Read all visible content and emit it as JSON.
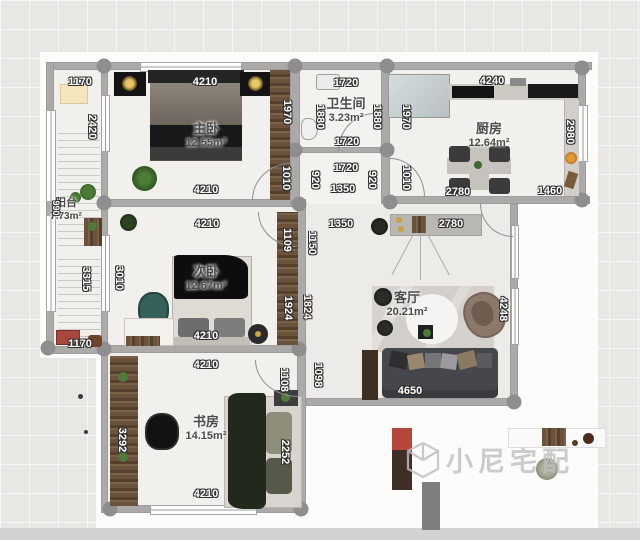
{
  "watermark": {
    "text": "小尼宅配"
  },
  "rooms": [
    {
      "name": "主卧",
      "area": "12.55m²",
      "x": 206,
      "y": 136,
      "small": false
    },
    {
      "name": "卫生间",
      "area": "3.23m²",
      "x": 346,
      "y": 111,
      "small": false
    },
    {
      "name": "厨房",
      "area": "12.64m²",
      "x": 489,
      "y": 136,
      "small": false
    },
    {
      "name": "阳台",
      "area": "7.73m²",
      "x": 66,
      "y": 210,
      "small": true
    },
    {
      "name": "次卧",
      "area": "12.67m²",
      "x": 206,
      "y": 279,
      "small": false
    },
    {
      "name": "客厅",
      "area": "20.21m²",
      "x": 407,
      "y": 305,
      "small": false
    },
    {
      "name": "书房",
      "area": "14.15m²",
      "x": 206,
      "y": 429,
      "small": false
    }
  ],
  "dims": [
    {
      "t": "1170",
      "x": 80,
      "y": 82,
      "o": "h"
    },
    {
      "t": "4210",
      "x": 205,
      "y": 82,
      "o": "h"
    },
    {
      "t": "1720",
      "x": 346,
      "y": 83,
      "o": "h"
    },
    {
      "t": "4240",
      "x": 492,
      "y": 81,
      "o": "h"
    },
    {
      "t": "1720",
      "x": 347,
      "y": 142,
      "o": "h"
    },
    {
      "t": "1720",
      "x": 346,
      "y": 168,
      "o": "h"
    },
    {
      "t": "1350",
      "x": 343,
      "y": 189,
      "o": "h"
    },
    {
      "t": "2780",
      "x": 458,
      "y": 192,
      "o": "h"
    },
    {
      "t": "1460",
      "x": 550,
      "y": 191,
      "o": "h"
    },
    {
      "t": "4210",
      "x": 206,
      "y": 190,
      "o": "h"
    },
    {
      "t": "4210",
      "x": 207,
      "y": 224,
      "o": "h"
    },
    {
      "t": "1350",
      "x": 341,
      "y": 224,
      "o": "h"
    },
    {
      "t": "2780",
      "x": 451,
      "y": 224,
      "o": "h"
    },
    {
      "t": "4210",
      "x": 206,
      "y": 336,
      "o": "h"
    },
    {
      "t": "1170",
      "x": 80,
      "y": 344,
      "o": "h"
    },
    {
      "t": "4210",
      "x": 206,
      "y": 365,
      "o": "h"
    },
    {
      "t": "4650",
      "x": 410,
      "y": 391,
      "o": "h"
    },
    {
      "t": "4210",
      "x": 206,
      "y": 494,
      "o": "h"
    },
    {
      "t": "2420",
      "x": 92,
      "y": 127,
      "o": "v"
    },
    {
      "t": "990",
      "x": 56,
      "y": 208,
      "o": "v",
      "small": true
    },
    {
      "t": "3315",
      "x": 86,
      "y": 279,
      "o": "v"
    },
    {
      "t": "3010",
      "x": 119,
      "y": 278,
      "o": "v"
    },
    {
      "t": "1970",
      "x": 287,
      "y": 112,
      "o": "v"
    },
    {
      "t": "1010",
      "x": 286,
      "y": 178,
      "o": "v"
    },
    {
      "t": "1880",
      "x": 320,
      "y": 117,
      "o": "v"
    },
    {
      "t": "1880",
      "x": 377,
      "y": 117,
      "o": "v"
    },
    {
      "t": "920",
      "x": 315,
      "y": 180,
      "o": "v"
    },
    {
      "t": "920",
      "x": 372,
      "y": 180,
      "o": "v"
    },
    {
      "t": "1970",
      "x": 406,
      "y": 117,
      "o": "v"
    },
    {
      "t": "1010",
      "x": 406,
      "y": 178,
      "o": "v"
    },
    {
      "t": "2980",
      "x": 570,
      "y": 132,
      "o": "v"
    },
    {
      "t": "1109",
      "x": 287,
      "y": 240,
      "o": "v"
    },
    {
      "t": "1150",
      "x": 312,
      "y": 243,
      "o": "v"
    },
    {
      "t": "1924",
      "x": 288,
      "y": 308,
      "o": "v"
    },
    {
      "t": "1824",
      "x": 307,
      "y": 307,
      "o": "v"
    },
    {
      "t": "4248",
      "x": 503,
      "y": 309,
      "o": "v"
    },
    {
      "t": "1098",
      "x": 318,
      "y": 375,
      "o": "v"
    },
    {
      "t": "1108",
      "x": 284,
      "y": 380,
      "o": "v"
    },
    {
      "t": "3292",
      "x": 122,
      "y": 440,
      "o": "v"
    },
    {
      "t": "2252",
      "x": 285,
      "y": 452,
      "o": "v"
    }
  ]
}
